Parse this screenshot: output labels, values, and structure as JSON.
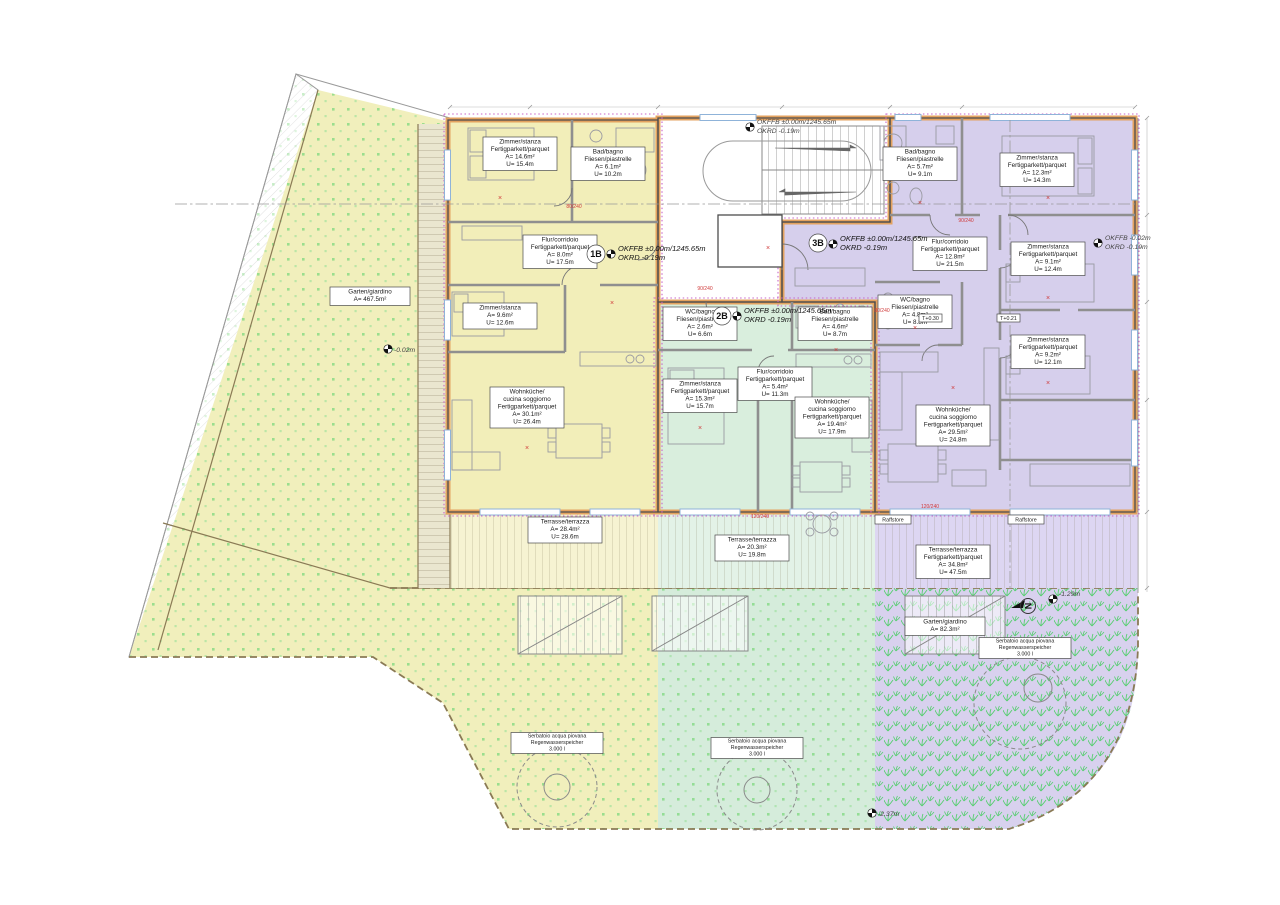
{
  "drawing": {
    "type": "floor-plan-site-plan",
    "accent_colors": {
      "apartment_1B": "#f2eeb9",
      "apartment_2B": "#d9eedd",
      "apartment_3B": "#d6cfec",
      "wall_orange": "#e3a25f",
      "insulation_magenta": "#c863c8",
      "grass_green": "#7fd87f",
      "annotation_red": "#d03a3a"
    }
  },
  "levels": {
    "main1": "OKFFB ±0.00m/1245.65m",
    "main2": "OKRD -0.19m",
    "right1": "OKFFB -0.02m",
    "right2": "OKRD -0.19m",
    "garden_left": "-0.02m",
    "garden_right": "-1.29m",
    "garden_bottom": "-2.37m",
    "north": "N"
  },
  "apartments": [
    {
      "id": "1B",
      "rooms": [
        {
          "lines": [
            "Zimmer/stanza",
            "Fertigparkett/parquet",
            "A= 14.6m²",
            "U= 15.4m"
          ]
        },
        {
          "lines": [
            "Bad/bagno",
            "Fliesen/piastrelle",
            "A= 6.1m²",
            "U= 10.2m"
          ]
        },
        {
          "lines": [
            "Flur/corridoio",
            "Fertigparkett/parquet",
            "A= 8.0m²",
            "U= 17.5m"
          ]
        },
        {
          "lines": [
            "Zimmer/stanza",
            "A= 9.6m²",
            "U= 12.6m"
          ]
        },
        {
          "lines": [
            "Wohnküche/",
            "cucina soggiorno",
            "Fertigparkett/parquet",
            "A= 30.1m²",
            "U= 26.4m"
          ]
        },
        {
          "lines": [
            "Terrasse/terrazza",
            "A= 28.4m²",
            "U= 28.6m"
          ]
        }
      ]
    },
    {
      "id": "2B",
      "rooms": [
        {
          "lines": [
            "WC/bagno",
            "Fliesen/piastrelle",
            "A= 2.6m²",
            "U= 6.6m"
          ]
        },
        {
          "lines": [
            "Bad/bagno",
            "Fliesen/piastrelle",
            "A= 4.6m²",
            "U= 8.7m"
          ]
        },
        {
          "lines": [
            "Zimmer/stanza",
            "Fertigparkett/parquet",
            "A= 15.3m²",
            "U= 15.7m"
          ]
        },
        {
          "lines": [
            "Flur/corridoio",
            "Fertigparkett/parquet",
            "A= 5.4m²",
            "U= 11.3m"
          ]
        },
        {
          "lines": [
            "Wohnküche/",
            "cucina soggiorno",
            "Fertigparkett/parquet",
            "A= 19.4m²",
            "U= 17.9m"
          ]
        },
        {
          "lines": [
            "Terrasse/terrazza",
            "A= 20.3m²",
            "U= 19.8m"
          ]
        }
      ]
    },
    {
      "id": "3B",
      "rooms": [
        {
          "lines": [
            "Bad/bagno",
            "Fliesen/piastrelle",
            "A= 5.7m²",
            "U= 9.1m"
          ]
        },
        {
          "lines": [
            "Zimmer/stanza",
            "Fertigparkett/parquet",
            "A= 12.3m²",
            "U= 14.3m"
          ]
        },
        {
          "lines": [
            "Flur/corridoio",
            "Fertigparkett/parquet",
            "A= 12.8m²",
            "U= 21.5m"
          ]
        },
        {
          "lines": [
            "Zimmer/stanza",
            "Fertigparkett/parquet",
            "A= 9.1m²",
            "U= 12.4m"
          ]
        },
        {
          "lines": [
            "WC/bagno",
            "Fliesen/piastrelle",
            "A= 4.8m²",
            "U= 8.8m"
          ]
        },
        {
          "lines": [
            "Zimmer/stanza",
            "Fertigparkett/parquet",
            "A= 9.2m²",
            "U= 12.1m"
          ]
        },
        {
          "lines": [
            "Wohnküche/",
            "cucina soggiorno",
            "Fertigparkett/parquet",
            "A= 29.5m²",
            "U= 24.8m"
          ]
        },
        {
          "lines": [
            "Terrasse/terrazza",
            "Fertigparkett/parquet",
            "A= 34.8m²",
            "U= 47.5m"
          ]
        }
      ]
    }
  ],
  "gardens": {
    "left": {
      "lines": [
        "Garten/giardino",
        "A= 467.5m²"
      ]
    },
    "right": {
      "lines": [
        "Garten/giardino",
        "A= 82.3m²"
      ]
    },
    "tank": {
      "lines": [
        "Serbatoio acqua piovana",
        "Regenwasserspeicher",
        "3.000 l"
      ]
    }
  },
  "tags": {
    "raffstore": "Raffstore",
    "t030": "T+0.30",
    "t021": "T+0.21",
    "d90": "90/240",
    "d80": "80/240",
    "d120": "120/240",
    "x": "×"
  }
}
